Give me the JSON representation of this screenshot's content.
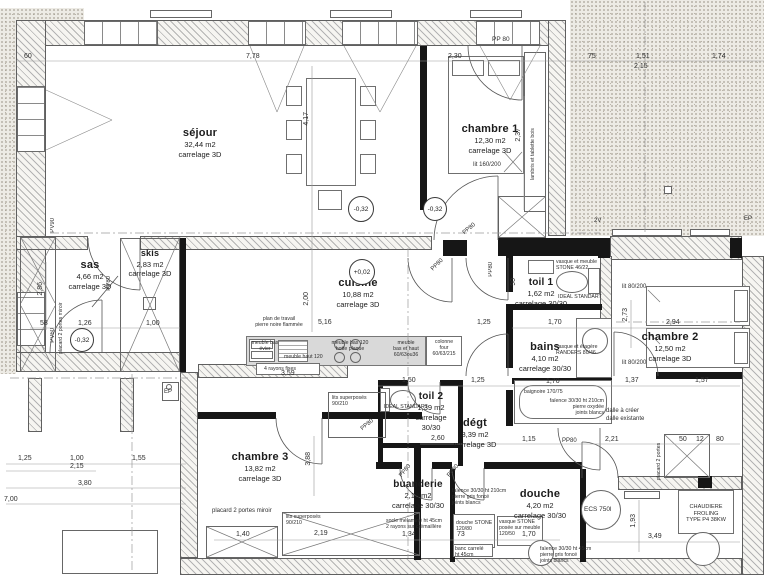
{
  "rooms": [
    {
      "name": "séjour",
      "area": "32,44 m2",
      "floor": "carrelage 3D"
    },
    {
      "name": "chambre 1",
      "area": "12,30 m2",
      "floor": "carrelage 3D"
    },
    {
      "name": "sas",
      "area": "4,66 m2",
      "floor": "carrelage 3D"
    },
    {
      "name": "skis",
      "area": "2,83 m2",
      "floor": "carrelage 3D"
    },
    {
      "name": "cuisine",
      "area": "10,88 m2",
      "floor": "carrelage 3D"
    },
    {
      "name": "toil 1",
      "area": "1,62 m2",
      "floor": "carrelage 30/30"
    },
    {
      "name": "bains",
      "area": "4,10 m2",
      "floor": "carrelage 30/30"
    },
    {
      "name": "chambre 2",
      "area": "12,50 m2",
      "floor": "carrelage 3D"
    },
    {
      "name": "toil 2",
      "area": "1,39 m2",
      "floor": "carrelage 30/30"
    },
    {
      "name": "dégt",
      "area": "8,39 m2",
      "floor": "carrelage 3D"
    },
    {
      "name": "chambre 3",
      "area": "13,82 m2",
      "floor": "carrelage 3D"
    },
    {
      "name": "buanderie",
      "area": "2,18 m2",
      "floor": "carrelage 30/30"
    },
    {
      "name": "douche",
      "area": "4,20 m2",
      "floor": "carrelage 30/30"
    }
  ],
  "levels": {
    "sejour": "-0,32",
    "chambre1": "-0,32",
    "sas": "-0,32",
    "cuisine": "+0,02"
  },
  "doors": {
    "pp80": "PP80",
    "pp80_sep": "PP 80",
    "pv60": "PV60",
    "pv90": "PV90"
  },
  "marks": {
    "two_v": "2V",
    "ep": "EP"
  },
  "furniture": {
    "lit160": "lit 160/200",
    "lit80": "lit 80/200",
    "lambris": "lambris et tablette bois",
    "placard_miroir": "placard 2 portes miroir",
    "placard": "placard 2 portes",
    "lits_sup": "lits superposés",
    "lits_sup_dim": "90/210",
    "plan_travail_1": "plan de travail",
    "plan_travail_2": "pierre noire flammée",
    "meuble_evier_1": "meuble bas",
    "meuble_evier_2": "évier",
    "meuble_haut": "meuble haut 120",
    "meuble_hotte_1": "meuble bas 120",
    "meuble_hotte_2": "hotte plaque",
    "meuble_bh_1": "meuble",
    "meuble_bh_2": "bas et haut",
    "meuble_bh_3": "60/63ou36",
    "four_1": "colonne",
    "four_2": "four",
    "four_3": "60/63/215",
    "rayons": "4 rayons fixes",
    "vasque_toil1_1": "vasque et meuble",
    "vasque_toil1_2": "STONE 46/22",
    "ideal": "IDEAL STANDART",
    "vasque_bains_1": "vasque et étagère",
    "vasque_bains_2": "RANDERS 80/46",
    "baignoire": "baignoire 170/75",
    "bain_note_1": "faïence 30/30 ht 210cm",
    "bain_note_2": "pierre oxydée",
    "bain_note_3": "joints blancs",
    "dalle_1": "dalle à créer",
    "dalle_2": "dalle existante",
    "socle_1": "socle mélaminé ht 45cm",
    "socle_2": "2 rayons sur crémaillère",
    "faience_1": "faïence 30/30 ht 210cm",
    "faience_2": "pierre gris foncé",
    "faience_3": "joints blancs",
    "douche_stone_1": "douche STONE",
    "douche_stone_2": "120/80",
    "banc_1": "banc carrelé",
    "banc_2": "ht 45cm",
    "vasque_douche_1": "vasque STONE",
    "vasque_douche_2": "posée sur meuble",
    "vasque_douche_3": "120/50",
    "faience45_1": "faïence 30/30 ht 45cm",
    "faience45_2": "pierre gris foncé",
    "faience45_3": "joints blancs",
    "ecs": "ECS 750l",
    "chaudiere_1": "CHAUDIERE FROLING",
    "chaudiere_2": "TYPE P4 38KW"
  },
  "dims": [
    "60",
    "7,78",
    "2,30",
    "75",
    "1,51",
    "2,15",
    "1,74",
    "4,17",
    "2,00",
    "2,37",
    "5,16",
    "58",
    "1,26",
    "1,00",
    "2,86",
    "1,25",
    "1,70",
    "90",
    "2,73",
    "2,94",
    "3,59",
    "1,50",
    "1,25",
    "1,70",
    "1,37",
    "1,57",
    "2,60",
    "1,15",
    "2,21",
    "50",
    "12",
    "80",
    "3,88",
    "1,40",
    "2,19",
    "1,34",
    "73",
    "1,70",
    "1,93",
    "3,49",
    "1,25",
    "1,00",
    "1,55",
    "2,15",
    "3,80",
    "7,00"
  ]
}
